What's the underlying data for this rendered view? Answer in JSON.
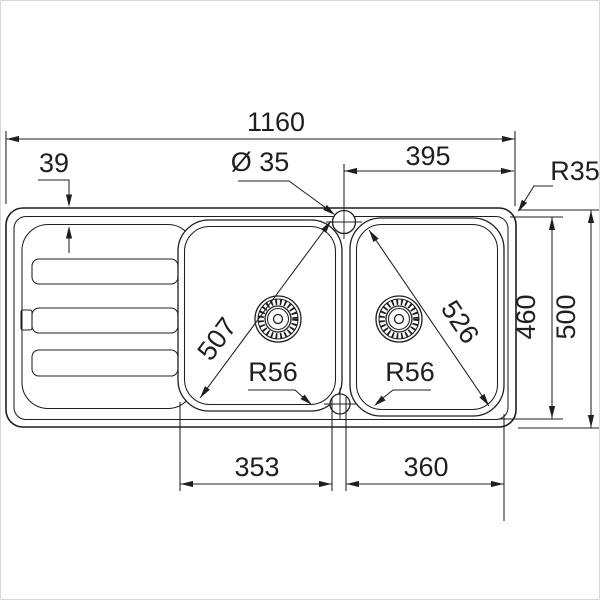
{
  "drawing": {
    "title": "double-bowl kitchen sink with drainer - top view dimension drawing",
    "unit": "mm",
    "colors": {
      "line": "#1f1f1f",
      "background": "#ffffff",
      "frame": "#d9d9d9"
    },
    "dimensions": {
      "overall_width": "1160",
      "rim_width": "39",
      "tap_hole_diameter": "Ø 35",
      "tap_hole_to_right_edge": "395",
      "outer_corner_radius": "R35",
      "inner_depth": "460",
      "overall_depth": "500",
      "left_bowl_diagonal": "507",
      "right_bowl_diagonal": "526",
      "left_bowl_corner_radius": "R56",
      "right_bowl_corner_radius": "R56",
      "left_bowl_width": "353",
      "right_bowl_width": "360"
    }
  }
}
